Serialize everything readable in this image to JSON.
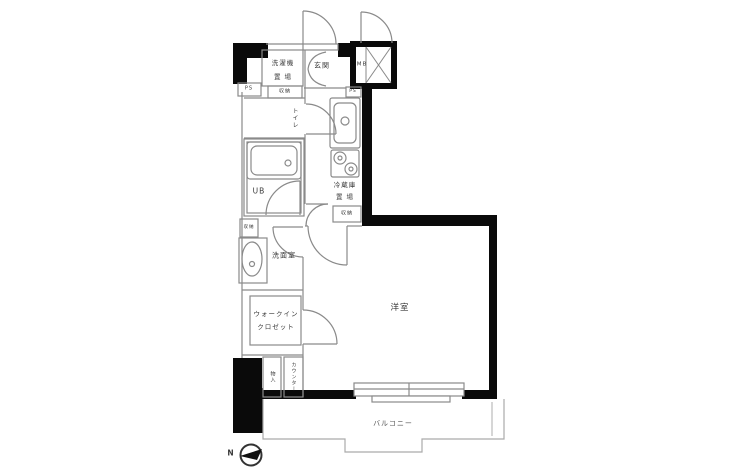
{
  "colors": {
    "background": "#ffffff",
    "wall": "#0a0a0a",
    "thin_line": "#8a8a8a",
    "light_line": "#aaaaaa",
    "text": "#3a3a3a"
  },
  "floorplan": {
    "entrance": {
      "label": "玄関"
    },
    "meter_box": {
      "label": "MB"
    },
    "pipe_shaft_left": {
      "label": "PS"
    },
    "pipe_shaft_kitchen": {
      "label": "PS"
    },
    "laundry": {
      "line1": "洗濯機",
      "line2": "置 場"
    },
    "storage_entrance": {
      "label": "収納"
    },
    "toilet": {
      "label": "トイレ"
    },
    "unit_bath": {
      "label": "UB"
    },
    "refrigerator": {
      "line1": "冷蔵庫",
      "line2": "置 場"
    },
    "storage_kitchen": {
      "label": "収納"
    },
    "storage_washroom": {
      "label": "収納"
    },
    "washroom": {
      "label": "洗面室"
    },
    "walk_in_closet": {
      "line1": "ウォークイン",
      "line2": "クロゼット"
    },
    "storage_closet": {
      "label": "物入"
    },
    "counter": {
      "label": "カウンター"
    },
    "western_room": {
      "label": "洋室"
    },
    "balcony": {
      "label": "バルコニー"
    },
    "compass": {
      "label": "N"
    }
  }
}
